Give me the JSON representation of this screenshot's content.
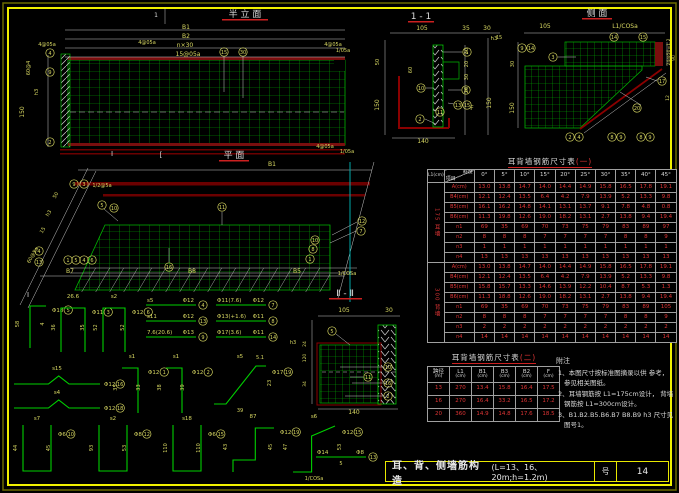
{
  "colors": {
    "accent_green": "#00b400",
    "dim_yellow": "#d8d862",
    "maroon": "#8b0000",
    "value_red": "#e03535",
    "frame_yellow": "#f0f000",
    "cyan": "#00a8a8",
    "white": "#dcdcdc"
  },
  "view_titles": {
    "half_elevation": "半 立 面",
    "plan": "平  面",
    "section_1_1": "1 - 1",
    "side": "侧  面",
    "section_2_2": "Ⅱ - Ⅱ"
  },
  "titlebar": {
    "title": "耳、背、侧墙筋构造",
    "spec": "(L=13、16、20m;h=1.2m)",
    "sheet_label": "号",
    "sheet_no": "14"
  },
  "notes": {
    "header": "附注",
    "items": [
      "1、本图尺寸按标准图摘录以供 参考，参见相关图纸。",
      "2、耳墙钢筋按 L1=175cm设计， 背墙钢筋按 L1=300cm设计。",
      "3、B1.B2.B5.B6.B7 B8.B9 h3 尺寸见图号1。"
    ]
  },
  "table1": {
    "title_main": "耳背墙钢筋尺寸表",
    "title_suffix": "(一)",
    "left_header": "L1(cm)",
    "corner_top": "斜度",
    "corner_bottom": "项目",
    "angles": [
      "0°",
      "5°",
      "10°",
      "15°",
      "20°",
      "25°",
      "30°",
      "35°",
      "40°",
      "45°"
    ],
    "groups": [
      {
        "label": "175 耳墙",
        "rows": [
          {
            "label": "A(cm)",
            "v": [
              "13.0",
              "13.8",
              "14.7",
              "14.0",
              "14.4",
              "14.9",
              "15.8",
              "16.5",
              "17.8",
              "19.1"
            ]
          },
          {
            "label": "B4(cm)",
            "v": [
              "12.1",
              "12.4",
              "13.5",
              "6.4",
              "4.2",
              "7.9",
              "13.9",
              "5.2",
              "13.3",
              "9.8"
            ]
          },
          {
            "label": "B5(cm)",
            "v": [
              "16.1",
              "16.2",
              "14.8",
              "14.1",
              "13.1",
              "13.7",
              "9.1",
              "7.8",
              "4.8",
              "0.8"
            ]
          },
          {
            "label": "B6(cm)",
            "v": [
              "11.3",
              "19.8",
              "12.6",
              "19.0",
              "18.2",
              "13.1",
              "2.7",
              "13.8",
              "9.4",
              "19.4"
            ]
          },
          {
            "label": "n1",
            "v": [
              "69",
              "35",
              "69",
              "70",
              "73",
              "75",
              "79",
              "83",
              "89",
              "97"
            ]
          },
          {
            "label": "n2",
            "v": [
              "8",
              "8",
              "8",
              "7",
              "7",
              "7",
              "7",
              "8",
              "8",
              "9"
            ]
          },
          {
            "label": "n3",
            "v": [
              "1",
              "1",
              "1",
              "1",
              "1",
              "1",
              "1",
              "1",
              "1",
              "1"
            ]
          },
          {
            "label": "n4",
            "v": [
              "13",
              "13",
              "13",
              "13",
              "13",
              "13",
              "13",
              "13",
              "13",
              "13"
            ]
          }
        ]
      },
      {
        "label": "300 背墙",
        "rows": [
          {
            "label": "A(cm)",
            "v": [
              "13.0",
              "13.8",
              "14.7",
              "14.0",
              "14.4",
              "14.9",
              "15.8",
              "16.5",
              "17.8",
              "19.1"
            ]
          },
          {
            "label": "B4(cm)",
            "v": [
              "12.1",
              "12.4",
              "13.5",
              "6.4",
              "4.2",
              "7.9",
              "13.9",
              "5.2",
              "13.3",
              "9.8"
            ]
          },
          {
            "label": "B5(cm)",
            "v": [
              "15.8",
              "15.7",
              "13.3",
              "14.6",
              "13.9",
              "12.2",
              "10.4",
              "8.7",
              "5.3",
              "1.3"
            ]
          },
          {
            "label": "B6(cm)",
            "v": [
              "11.3",
              "18.8",
              "12.6",
              "19.0",
              "18.2",
              "13.1",
              "2.7",
              "13.8",
              "9.4",
              "19.4"
            ]
          },
          {
            "label": "n1",
            "v": [
              "69",
              "35",
              "69",
              "70",
              "73",
              "75",
              "79",
              "83",
              "89",
              "105"
            ]
          },
          {
            "label": "n2",
            "v": [
              "8",
              "8",
              "8",
              "7",
              "7",
              "7",
              "7",
              "8",
              "8",
              "9"
            ]
          },
          {
            "label": "n3",
            "v": [
              "2",
              "2",
              "2",
              "2",
              "2",
              "2",
              "2",
              "2",
              "2",
              "2"
            ]
          },
          {
            "label": "n4",
            "v": [
              "14",
              "14",
              "14",
              "14",
              "14",
              "14",
              "14",
              "14",
              "14",
              "14"
            ]
          }
        ]
      }
    ]
  },
  "table2": {
    "title_main": "耳背墙钢筋尺寸表",
    "title_suffix": "(二)",
    "headers": [
      "跨径",
      "L1",
      "B1",
      "B3",
      "B2",
      "F"
    ],
    "units": [
      "(m)",
      "(cm)",
      "(cm)",
      "(cm)",
      "(cm)",
      "(cm)"
    ],
    "rows": [
      [
        "13",
        "270",
        "13.4",
        "15.8",
        "16.4",
        "17.5"
      ],
      [
        "16",
        "270",
        "16.4",
        "33.2",
        "16.5",
        "17.2"
      ],
      [
        "20",
        "360",
        "14.9",
        "14.8",
        "17.6",
        "18.5"
      ]
    ]
  },
  "labels": [
    {
      "x": 156,
      "y": 17,
      "t": "1",
      "c": "w"
    },
    {
      "x": 186,
      "y": 29,
      "t": "B1"
    },
    {
      "x": 186,
      "y": 38,
      "t": "B2"
    },
    {
      "x": 185,
      "y": 47,
      "t": "n×30"
    },
    {
      "x": 188,
      "y": 56,
      "t": "15@05a"
    },
    {
      "x": 147,
      "y": 44,
      "t": "4@05a",
      "s": 5
    },
    {
      "x": 47,
      "y": 46,
      "t": "4@05a",
      "s": 5
    },
    {
      "x": 333,
      "y": 46,
      "t": "4@05a",
      "s": 5
    },
    {
      "x": 343,
      "y": 52,
      "t": "1/05a",
      "s": 5
    },
    {
      "x": 30,
      "y": 68,
      "t": "60@4",
      "r": -90,
      "s": 5
    },
    {
      "x": 38,
      "y": 92,
      "t": "h3",
      "r": -90,
      "s": 5
    },
    {
      "x": 24,
      "y": 112,
      "t": "150",
      "r": -90
    },
    {
      "x": 325,
      "y": 148,
      "t": "4@05a",
      "s": 5
    },
    {
      "x": 347,
      "y": 153,
      "t": "1/05a",
      "s": 5
    },
    {
      "x": 112,
      "y": 156,
      "t": "Ⅰ",
      "c": "w",
      "s": 7
    },
    {
      "x": 161,
      "y": 157,
      "t": "[",
      "c": "w",
      "s": 7
    },
    {
      "x": 272,
      "y": 166,
      "t": "B1"
    },
    {
      "x": 102,
      "y": 187,
      "t": "1/2@5a",
      "s": 5
    },
    {
      "x": 57,
      "y": 196,
      "t": "50",
      "r": -60,
      "s": 5
    },
    {
      "x": 50,
      "y": 214,
      "t": "h3",
      "r": -60,
      "s": 5
    },
    {
      "x": 44,
      "y": 231,
      "t": "15",
      "r": -60,
      "s": 5
    },
    {
      "x": 34,
      "y": 256,
      "t": "60@5a",
      "r": -60,
      "s": 5
    },
    {
      "x": 28,
      "y": 297,
      "t": "Ⅰ",
      "c": "w",
      "s": 7
    },
    {
      "x": 70,
      "y": 273,
      "t": "B7"
    },
    {
      "x": 192,
      "y": 273,
      "t": "B8"
    },
    {
      "x": 297,
      "y": 273,
      "t": "B5"
    },
    {
      "x": 347,
      "y": 275,
      "t": "1/COSa",
      "s": 5
    },
    {
      "x": 422,
      "y": 30,
      "t": "105"
    },
    {
      "x": 466,
      "y": 30,
      "t": "35"
    },
    {
      "x": 487,
      "y": 30,
      "t": "30"
    },
    {
      "x": 499,
      "y": 39,
      "t": "15",
      "s": 5
    },
    {
      "x": 379,
      "y": 62,
      "t": "50",
      "r": -90,
      "s": 5
    },
    {
      "x": 379,
      "y": 105,
      "t": "150",
      "r": -90
    },
    {
      "x": 412,
      "y": 70,
      "t": "60",
      "r": -90,
      "s": 5
    },
    {
      "x": 468,
      "y": 51,
      "t": "30",
      "r": -90,
      "s": 5
    },
    {
      "x": 468,
      "y": 64,
      "t": "20",
      "r": -90,
      "s": 5
    },
    {
      "x": 468,
      "y": 77,
      "t": "30",
      "r": -90,
      "s": 5
    },
    {
      "x": 468,
      "y": 90,
      "t": "20",
      "r": -90,
      "s": 5
    },
    {
      "x": 472,
      "y": 110,
      "t": "F",
      "s": 6
    },
    {
      "x": 494,
      "y": 40,
      "t": "h3",
      "s": 5.5
    },
    {
      "x": 491,
      "y": 103,
      "t": "150",
      "r": -90
    },
    {
      "x": 423,
      "y": 143,
      "t": "140"
    },
    {
      "x": 545,
      "y": 28,
      "t": "105"
    },
    {
      "x": 625,
      "y": 28,
      "t": "L1/COSa"
    },
    {
      "x": 514,
      "y": 64,
      "t": "30",
      "r": -90,
      "s": 5
    },
    {
      "x": 514,
      "y": 108,
      "t": "150",
      "r": -90
    },
    {
      "x": 670,
      "y": 52,
      "t": "24@50=1.2",
      "r": -90,
      "s": 4.5
    },
    {
      "x": 675,
      "y": 58,
      "t": "90",
      "r": -90,
      "s": 4.5
    },
    {
      "x": 669,
      "y": 98,
      "t": "12",
      "r": -90,
      "s": 4.5
    },
    {
      "x": 344,
      "y": 312,
      "t": "105"
    },
    {
      "x": 389,
      "y": 312,
      "t": "30"
    },
    {
      "x": 306,
      "y": 344,
      "t": "24",
      "r": -90,
      "s": 4.5
    },
    {
      "x": 306,
      "y": 358,
      "t": "120",
      "r": -90,
      "s": 4.5
    },
    {
      "x": 306,
      "y": 384,
      "t": "34",
      "r": -90,
      "s": 4.5
    },
    {
      "x": 293,
      "y": 344,
      "t": "h3",
      "s": 5
    },
    {
      "x": 354,
      "y": 414,
      "t": "140"
    }
  ],
  "callouts": [
    {
      "x": 224,
      "y": 52,
      "n": "15"
    },
    {
      "x": 243,
      "y": 52,
      "n": "30"
    },
    {
      "x": 50,
      "y": 53,
      "n": "4"
    },
    {
      "x": 50,
      "y": 72,
      "n": "9"
    },
    {
      "x": 50,
      "y": 142,
      "n": "2"
    },
    {
      "x": 74,
      "y": 184,
      "n": "9"
    },
    {
      "x": 84,
      "y": 184,
      "n": "3"
    },
    {
      "x": 102,
      "y": 205,
      "n": "5"
    },
    {
      "x": 114,
      "y": 208,
      "n": "10"
    },
    {
      "x": 222,
      "y": 207,
      "n": "11"
    },
    {
      "x": 169,
      "y": 267,
      "n": "16"
    },
    {
      "x": 362,
      "y": 221,
      "n": "12"
    },
    {
      "x": 361,
      "y": 231,
      "n": "7"
    },
    {
      "x": 315,
      "y": 240,
      "n": "10"
    },
    {
      "x": 313,
      "y": 249,
      "n": "8"
    },
    {
      "x": 310,
      "y": 259,
      "n": "1"
    },
    {
      "x": 68,
      "y": 260,
      "n": "1"
    },
    {
      "x": 76,
      "y": 260,
      "n": "5"
    },
    {
      "x": 84,
      "y": 260,
      "n": "4"
    },
    {
      "x": 92,
      "y": 260,
      "n": "6"
    },
    {
      "x": 39,
      "y": 251,
      "n": "4"
    },
    {
      "x": 39,
      "y": 262,
      "n": "13"
    },
    {
      "x": 467,
      "y": 52,
      "n": "1"
    },
    {
      "x": 421,
      "y": 88,
      "n": "10"
    },
    {
      "x": 466,
      "y": 90,
      "n": "6"
    },
    {
      "x": 458,
      "y": 105,
      "n": "13"
    },
    {
      "x": 467,
      "y": 105,
      "n": "15"
    },
    {
      "x": 440,
      "y": 112,
      "n": "11"
    },
    {
      "x": 420,
      "y": 119,
      "n": "2"
    },
    {
      "x": 522,
      "y": 48,
      "n": "9"
    },
    {
      "x": 531,
      "y": 48,
      "n": "14"
    },
    {
      "x": 553,
      "y": 57,
      "n": "3"
    },
    {
      "x": 614,
      "y": 37,
      "n": "14"
    },
    {
      "x": 643,
      "y": 37,
      "n": "15"
    },
    {
      "x": 662,
      "y": 81,
      "n": "17"
    },
    {
      "x": 637,
      "y": 108,
      "n": "20"
    },
    {
      "x": 570,
      "y": 137,
      "n": "2"
    },
    {
      "x": 579,
      "y": 137,
      "n": "4"
    },
    {
      "x": 612,
      "y": 137,
      "n": "8"
    },
    {
      "x": 621,
      "y": 137,
      "n": "9"
    },
    {
      "x": 641,
      "y": 137,
      "n": "8"
    },
    {
      "x": 650,
      "y": 137,
      "n": "9"
    },
    {
      "x": 332,
      "y": 331,
      "n": "5"
    },
    {
      "x": 388,
      "y": 367,
      "n": "10"
    },
    {
      "x": 368,
      "y": 377,
      "n": "11"
    },
    {
      "x": 388,
      "y": 383,
      "n": "16"
    },
    {
      "x": 388,
      "y": 396,
      "n": "2"
    }
  ],
  "rebar_shapes": [
    {
      "x": 22,
      "y": 298,
      "w": 26,
      "h": 52,
      "sh": "J",
      "nm": "",
      "sp": "Φ18",
      "id": "5",
      "d1": "58",
      "d2": "4"
    },
    {
      "x": 58,
      "y": 300,
      "w": 30,
      "h": 55,
      "sh": "n",
      "nm": "26.6",
      "sp": "Φ11",
      "id": "3",
      "d1": "36",
      "d2": "35"
    },
    {
      "x": 100,
      "y": 300,
      "w": 28,
      "h": 55,
      "sh": "n",
      "nm": "s2",
      "sp": "Φ12",
      "id": "6",
      "d1": "52",
      "d2": "52"
    },
    {
      "x": 146,
      "y": 300,
      "w": 50,
      "h": 10,
      "sh": "bar",
      "nm": "s5",
      "sp": "Φ12",
      "id": "4"
    },
    {
      "x": 146,
      "y": 316,
      "w": 50,
      "h": 10,
      "sh": "bar",
      "nm": "s11",
      "sp": "Φ12",
      "id": "13"
    },
    {
      "x": 146,
      "y": 332,
      "w": 50,
      "h": 10,
      "sh": "bar",
      "nm": "7.6(20.6)",
      "sp": "Φ13",
      "id": "9"
    },
    {
      "x": 216,
      "y": 300,
      "w": 50,
      "h": 10,
      "sh": "bar",
      "nm": "Φ11(7.6)",
      "sp": "Φ12",
      "id": "7"
    },
    {
      "x": 216,
      "y": 316,
      "w": 50,
      "h": 10,
      "sh": "bar",
      "nm": "Φ13(+1.6)",
      "sp": "Φ11",
      "id": "8"
    },
    {
      "x": 216,
      "y": 332,
      "w": 50,
      "h": 10,
      "sh": "bar",
      "nm": "Φ17(3.6)",
      "sp": "Φ11",
      "id": "14"
    },
    {
      "x": 14,
      "y": 372,
      "w": 86,
      "h": 16,
      "sh": "Z",
      "nm": "s15",
      "sp": "Φ12",
      "id": "16"
    },
    {
      "x": 14,
      "y": 396,
      "w": 86,
      "h": 16,
      "sh": "Z",
      "nm": "s4",
      "sp": "Φ12",
      "id": "18"
    },
    {
      "x": 120,
      "y": 360,
      "w": 24,
      "h": 55,
      "sh": "P",
      "nm": "s1",
      "sp": "Φ12",
      "id": "1",
      "d1": "35",
      "d2": "33"
    },
    {
      "x": 164,
      "y": 360,
      "w": 24,
      "h": 55,
      "sh": "P",
      "nm": "s1",
      "sp": "Φ12",
      "id": "2",
      "d1": "38",
      "d2": "39"
    },
    {
      "x": 212,
      "y": 360,
      "w": 56,
      "h": 46,
      "sh": "G",
      "nm": "s5",
      "sp": "Φ17",
      "id": "19",
      "d1": "5.1",
      "d2": "23",
      "d3": "39"
    },
    {
      "x": 20,
      "y": 422,
      "w": 34,
      "h": 52,
      "sh": "U",
      "nm": "s7",
      "sp": "Φ6",
      "id": "10",
      "d1": "44",
      "d2": "45"
    },
    {
      "x": 96,
      "y": 422,
      "w": 34,
      "h": 52,
      "sh": "U",
      "nm": "s2",
      "sp": "Φ8",
      "id": "12",
      "d1": "93",
      "d2": "53"
    },
    {
      "x": 170,
      "y": 422,
      "w": 34,
      "h": 52,
      "sh": "U",
      "nm": "s18",
      "sp": "Φ6",
      "id": "15",
      "d1": "110",
      "d2": "110"
    },
    {
      "x": 230,
      "y": 420,
      "w": 46,
      "h": 54,
      "sh": "S",
      "nm": "87",
      "sp": "Φ12",
      "id": "19",
      "d1": "43",
      "d2": "45"
    },
    {
      "x": 290,
      "y": 420,
      "w": 48,
      "h": 54,
      "sh": "S2",
      "nm": "s6",
      "sp": "Φ12",
      "id": "15",
      "d1": "47",
      "d2": "53",
      "d3": "1/COSa"
    },
    {
      "x": 316,
      "y": 452,
      "w": 50,
      "h": 10,
      "sh": "bar",
      "nm": "Φ14",
      "sp": "Φ8",
      "id": "13",
      "d1": "5"
    }
  ]
}
